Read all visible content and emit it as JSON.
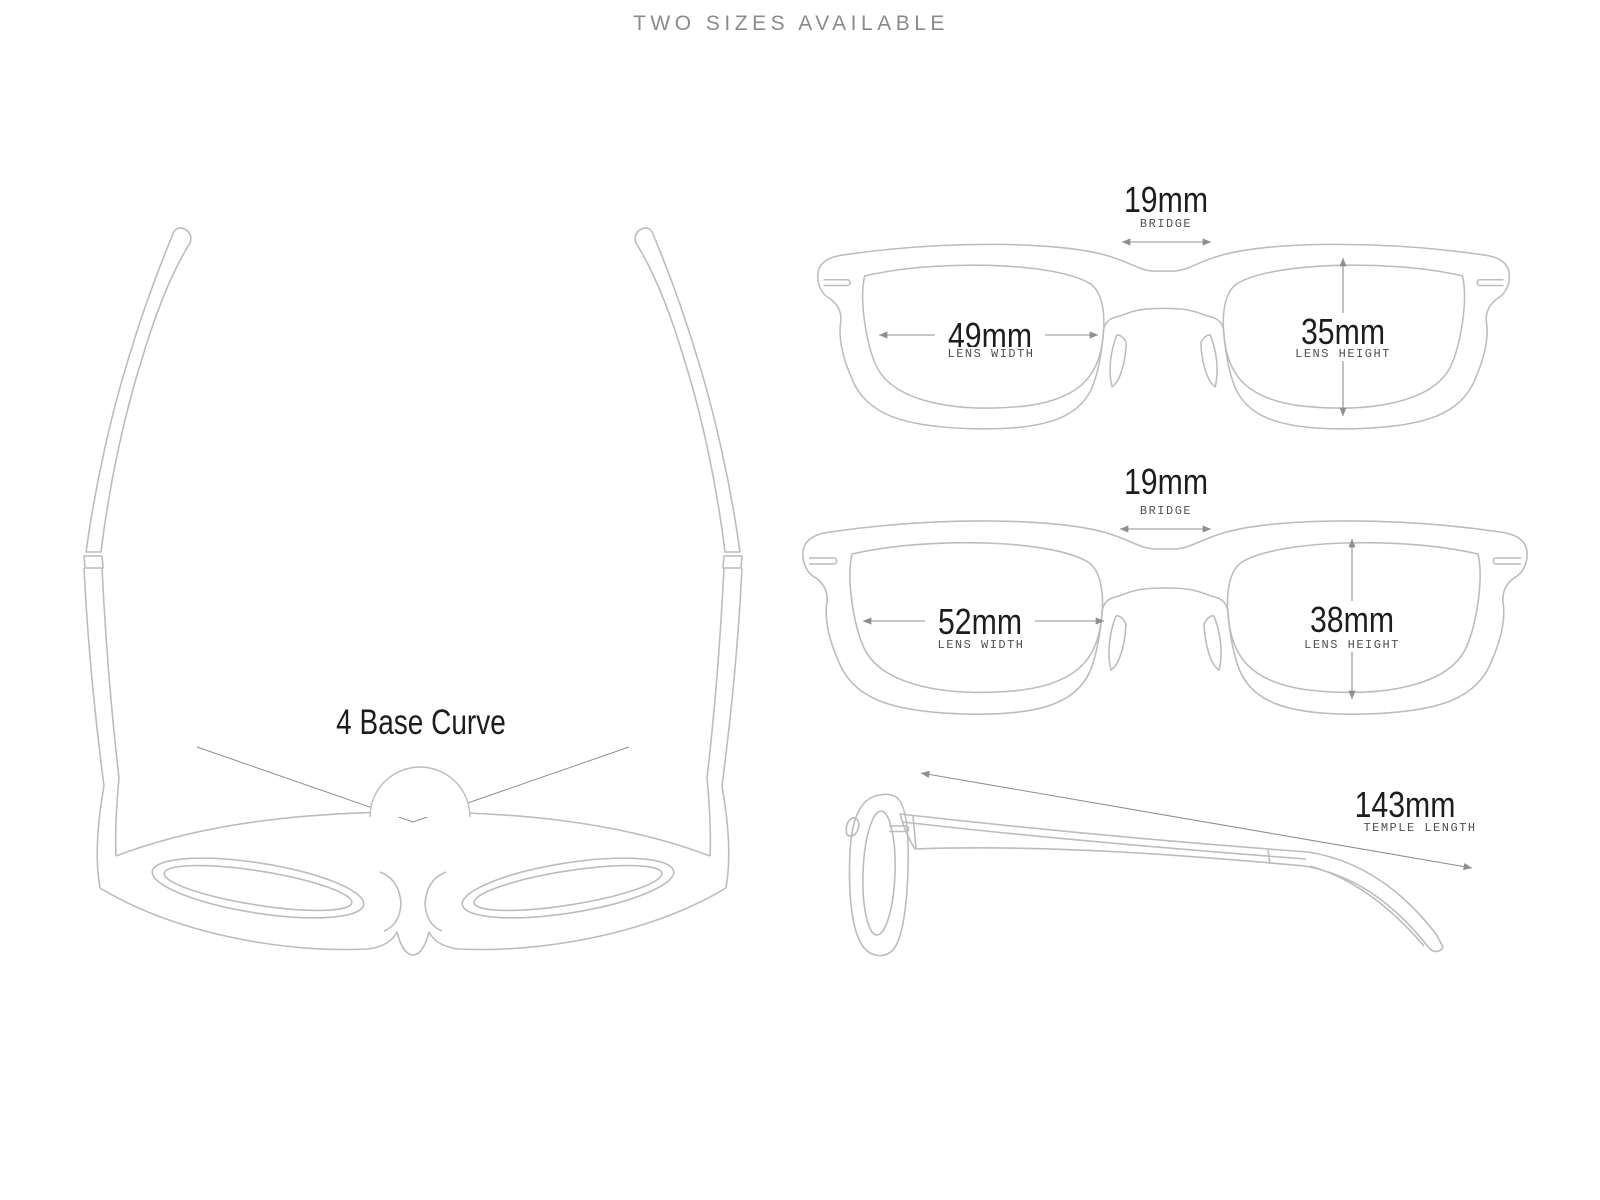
{
  "title": "TWO SIZES AVAILABLE",
  "top_view": {
    "base_curve": "4 Base Curve"
  },
  "size_small": {
    "bridge_value": "19mm",
    "bridge_label": "BRIDGE",
    "lens_width_value": "49mm",
    "lens_width_label": "LENS WIDTH",
    "lens_height_value": "35mm",
    "lens_height_label": "LENS HEIGHT"
  },
  "size_large": {
    "bridge_value": "19mm",
    "bridge_label": "BRIDGE",
    "lens_width_value": "52mm",
    "lens_width_label": "LENS WIDTH",
    "lens_height_value": "38mm",
    "lens_height_label": "LENS HEIGHT"
  },
  "side_view": {
    "temple_value": "143mm",
    "temple_label": "TEMPLE LENGTH"
  },
  "colors": {
    "line": "#bcbcbc",
    "measure": "#8f8f8f",
    "number": "#1d1d1d",
    "label": "#4f4f4f",
    "title": "#8a8a8a",
    "background": "#ffffff"
  }
}
